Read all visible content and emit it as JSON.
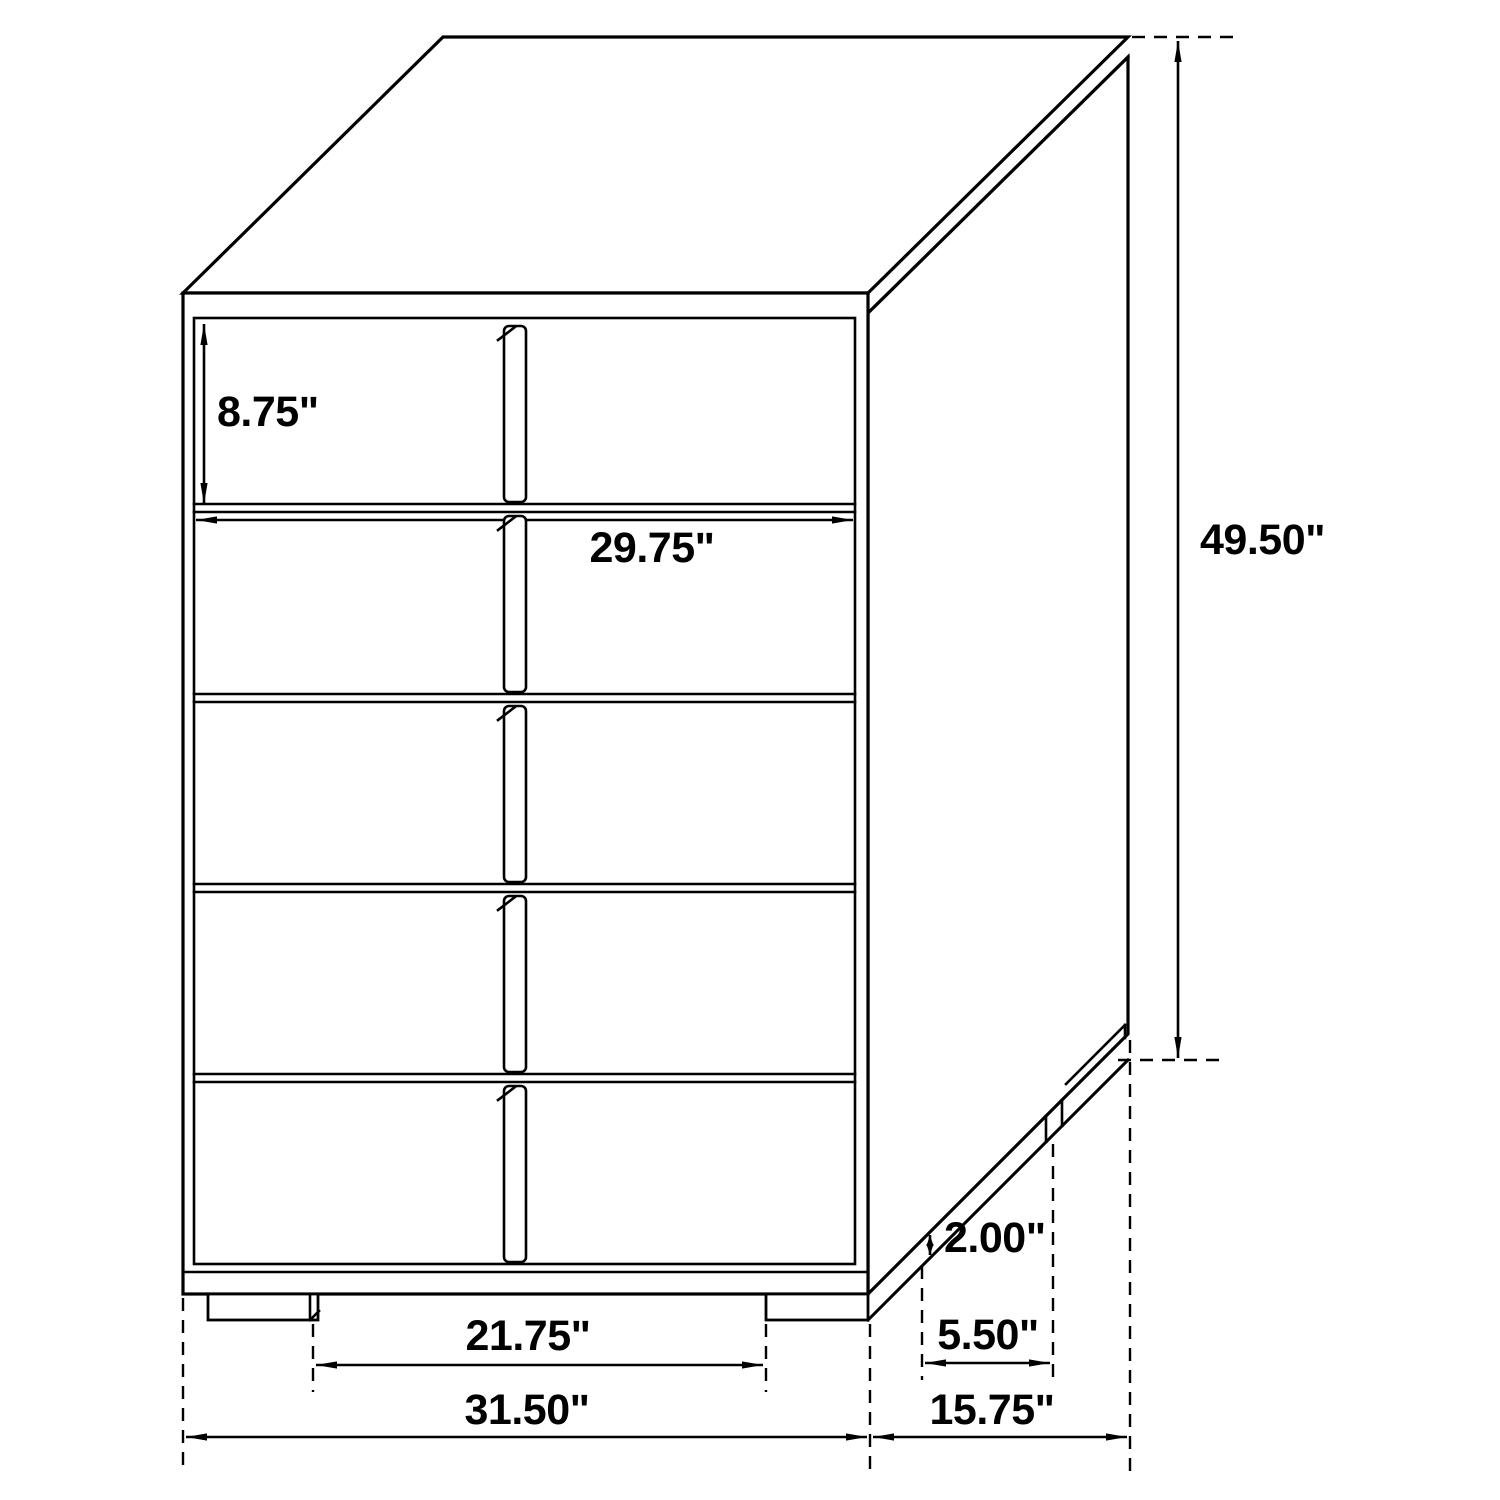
{
  "diagram": {
    "background_color": "#ffffff",
    "line_color": "#000000",
    "drawer_count": 5,
    "labels": {
      "drawer_height": "8.75\"",
      "drawer_width": "29.75\"",
      "overall_height": "49.50\"",
      "foot_height": "2.00\"",
      "side_foot_span": "5.50\"",
      "front_foot_span": "21.75\"",
      "overall_width": "31.50\"",
      "overall_depth": "15.75\""
    }
  }
}
